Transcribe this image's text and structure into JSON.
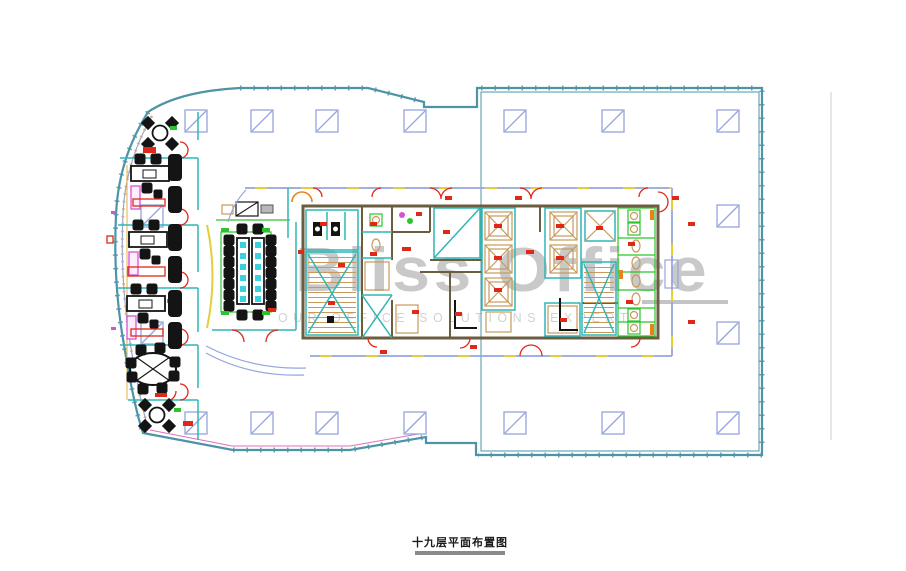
{
  "title": {
    "text": "十九层平面布置图"
  },
  "watermark": {
    "line1": "Bliss Office",
    "line2": "OUR OFFICE SOLUTIONS EXPERT"
  },
  "colors": {
    "fac": "#4d94a6",
    "peri": "#95a5dd",
    "teal": "#2fb6b6",
    "brown": "#6b5d40",
    "red": "#e02818",
    "grn": "#2cc42c",
    "tan": "#c89a5a",
    "mag": "#d455d4",
    "org": "#e8821e",
    "yel": "#e2cf3a",
    "cyan": "#3ad0e0",
    "pink": "#e070b8",
    "wm": "#c9c9c9",
    "title_bar": "#8a8a8a"
  }
}
